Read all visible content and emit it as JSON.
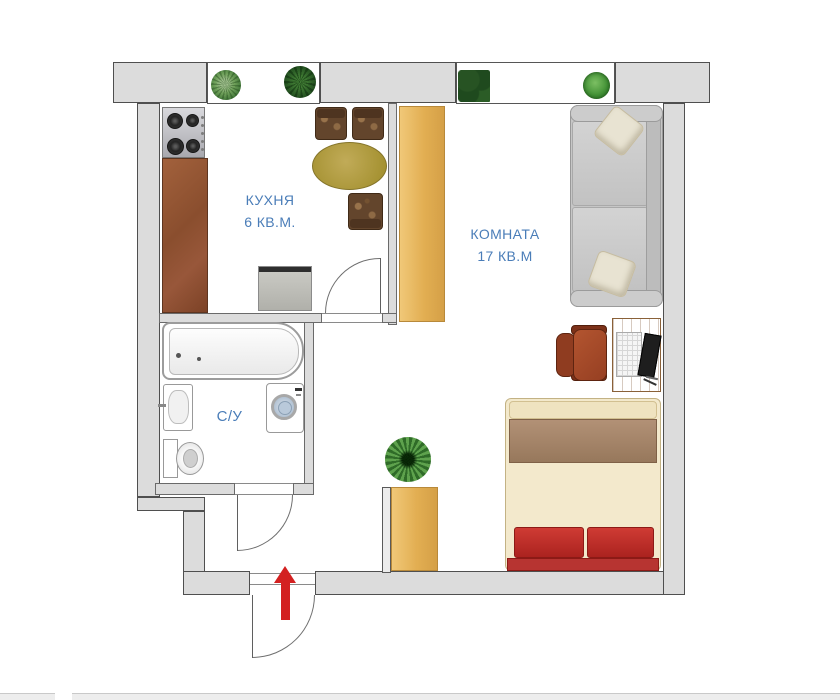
{
  "floorplan": {
    "kitchen": {
      "label": "КУХНЯ",
      "area": "6 КВ.М."
    },
    "room": {
      "label": "КОМНАТА",
      "area": "17 КВ.М"
    },
    "bathroom": {
      "label": "С/У"
    },
    "furniture": {
      "kitchen": [
        "stove",
        "counter",
        "fridge",
        "dining-table",
        "three-chairs"
      ],
      "room": [
        "wardrobe",
        "sofa-with-pillows",
        "desk-with-laptop",
        "office-chair",
        "double-bed"
      ],
      "bathroom": [
        "bathtub",
        "sink",
        "toilet",
        "washing-machine"
      ],
      "hallway": [
        "cabinet",
        "plant"
      ],
      "windowsills": [
        "four-plants"
      ]
    },
    "entrance": {
      "indicator": "red-arrow-up"
    }
  },
  "colors": {
    "label_text": "#4a7db8",
    "entrance_arrow": "#d32020",
    "walls": "#dcdcdc",
    "wood_light": "#e8b765",
    "wood_counter": "#8f5434",
    "sofa": "#c6c6c6",
    "bed_cream": "#f3e9cc",
    "bed_red": "#c23430",
    "table": "#b2a04e"
  }
}
